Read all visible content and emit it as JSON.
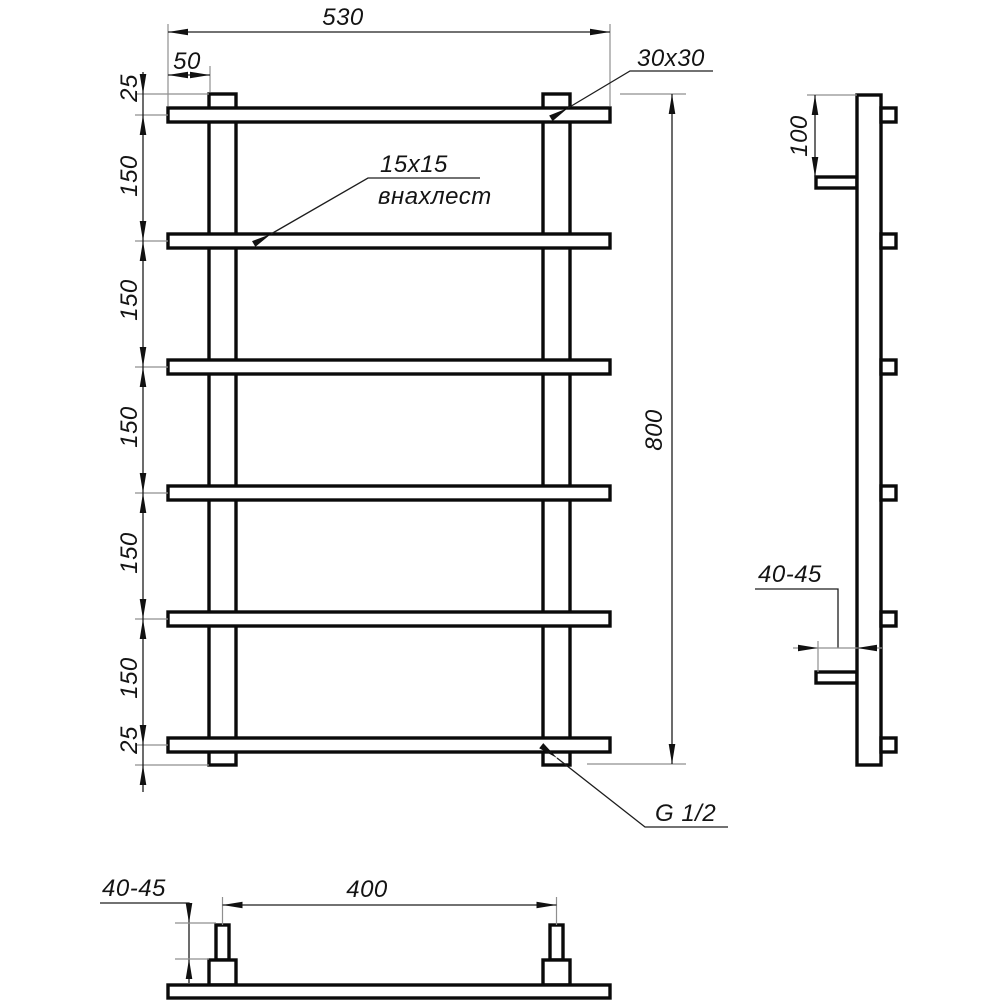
{
  "drawing": {
    "front_view": {
      "width": "530",
      "post_offset": "50",
      "top_margin": "25",
      "rung_spacing": "150",
      "bottom_margin": "25",
      "height": "800",
      "post_section": "30x30",
      "rung_section": "15x15",
      "overlap_note": "внахлест",
      "connection_thread": "G 1/2"
    },
    "side_view": {
      "bracket_offset": "100",
      "wall_gap": "40-45"
    },
    "bottom_view": {
      "mount_spacing": "400",
      "wall_gap": "40-45"
    }
  }
}
